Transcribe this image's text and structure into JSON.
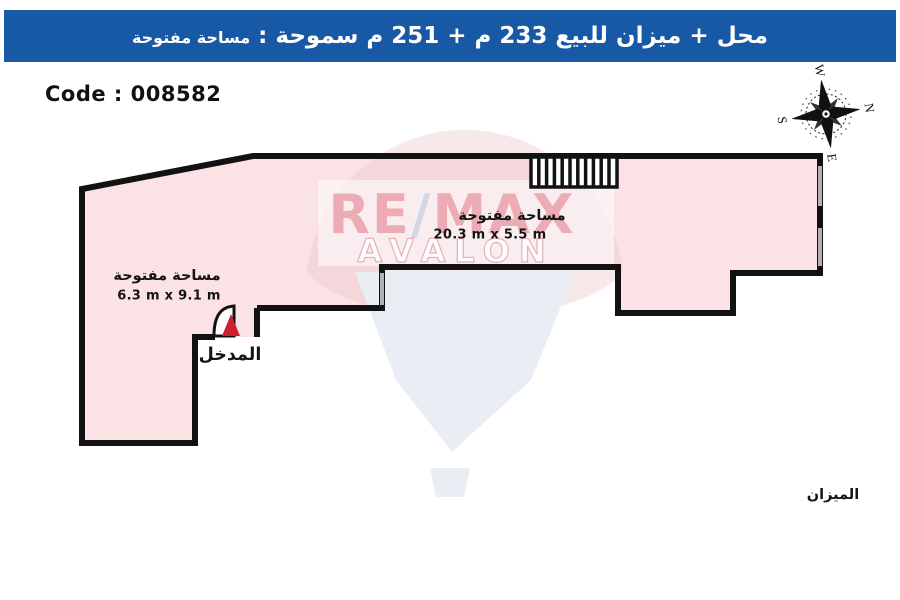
{
  "header": {
    "title_main": "محل + ميزان للبيع 233 م + 251 م سموحة :  ",
    "title_tail": "مساحة مفتوحة"
  },
  "code_label": "Code : 008582",
  "compass": {
    "n": "N",
    "e": "E",
    "s": "S",
    "w": "W"
  },
  "plan": {
    "area_left": {
      "name": "مساحة مفتوحة",
      "dims": "6.3 m x 9.1 m"
    },
    "area_top": {
      "name": "مساحة مفتوحة",
      "dims": "20.3 m x 5.5 m"
    },
    "entrance_label": "المدخل",
    "location_label": "الميزان"
  },
  "watermark": {
    "re": "RE",
    "slash": "/",
    "max": "MAX",
    "brand_office": "AVALON"
  },
  "colors": {
    "header": "#1859a5",
    "plan-fill": "#fae2e5",
    "wall": "#121212",
    "window": "#b3b3b3",
    "red": "#cd2030",
    "balloon-pink": "#edc8cd",
    "balloon-blue": "#e9eef4",
    "wm-red": "#d84a5f"
  }
}
